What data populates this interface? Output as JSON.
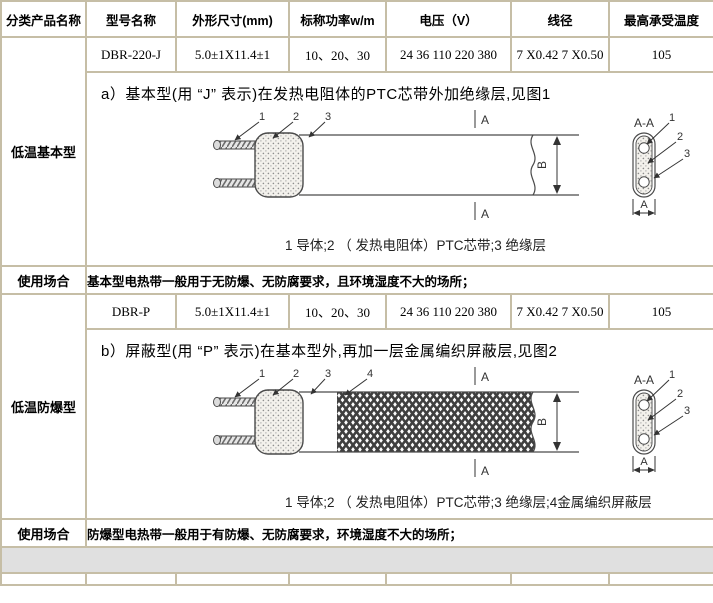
{
  "header": {
    "cols": [
      "分类产品名称",
      "型号名称",
      "外形尺寸(mm)",
      "标称功率w/m",
      "电压（V）",
      "线径",
      "最高承受温度"
    ]
  },
  "rows": [
    {
      "model": "DBR-220-J",
      "size": "5.0±1X11.4±1",
      "power": "10、20、30",
      "voltage": "24 36 110 220 380",
      "wire": "7 X0.42 7 X0.50",
      "temp": "105"
    },
    {
      "model": "DBR-P",
      "size": "5.0±1X11.4±1",
      "power": "10、20、30",
      "voltage": "24 36 110 220 380",
      "wire": "7 X0.42 7 X0.50",
      "temp": "105"
    }
  ],
  "left": {
    "cat1": "低温基本型",
    "cat2": "低温防爆型",
    "usage_label": "使用场合"
  },
  "sections": {
    "a_title": "a）基本型(用 “J” 表示)在发热电阻体的PTC芯带外加绝缘层,见图1",
    "a_caption": "1 导体;2 （ 发热电阻体）PTC芯带;3 绝缘层",
    "b_title": "b）屏蔽型(用 “P” 表示)在基本型外,再加一层金属编织屏蔽层,见图2",
    "b_caption": "1 导体;2 （ 发热电阻体）PTC芯带;3 绝缘层;4金属编织屏蔽层",
    "usage1": "基本型电热带一般用于无防爆、无防腐要求，且环境湿度不大的场所；",
    "usage2": "防爆型电热带一般用于有防爆、无防腐要求，环境湿度不大的场所；"
  },
  "figure": {
    "n1": "1",
    "n2": "2",
    "n3": "3",
    "n4": "4",
    "section_label": "A-A",
    "dim_a": "A",
    "dim_b": "B",
    "marker_a": "A"
  },
  "colors": {
    "border": "#c6bea6",
    "gray_row": "#e0e0e0"
  }
}
